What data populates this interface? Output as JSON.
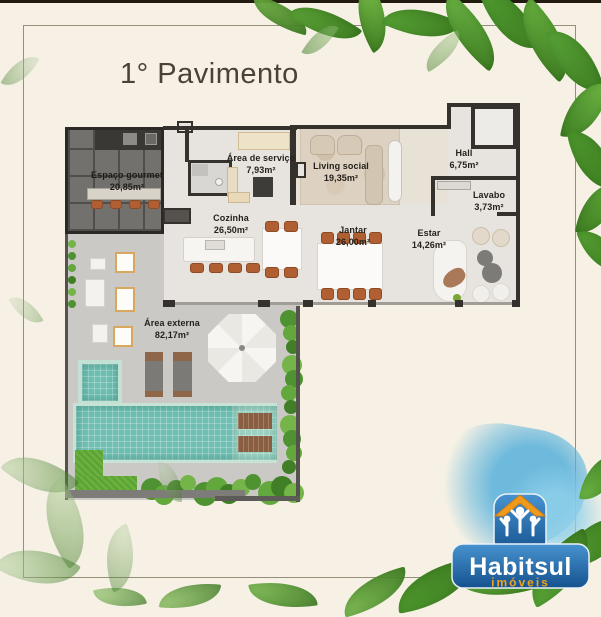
{
  "title": "1° Pavimento",
  "rooms": [
    {
      "name": "Espaço gourmet",
      "area": "20,85m²"
    },
    {
      "name": "Área de serviço",
      "area": "7,93m²"
    },
    {
      "name": "Living social",
      "area": "19,35m²"
    },
    {
      "name": "Hall",
      "area": "6,75m²"
    },
    {
      "name": "Lavabo",
      "area": "3,73m²"
    },
    {
      "name": "Cozinha",
      "area": "26,50m²"
    },
    {
      "name": "Jantar",
      "area": "26,00m²"
    },
    {
      "name": "Estar",
      "area": "14,26m²"
    },
    {
      "name": "Área externa",
      "area": "82,17m²"
    }
  ],
  "logo": {
    "brand": "Habitsul",
    "tagline": "imóveis"
  },
  "icons": {
    "logo_house": "house-with-family-icon"
  },
  "colors": {
    "background": "#f6f1e4",
    "wall": "#35322d",
    "pool_teal": "#6fbfb2",
    "chair_orange": "#b05f33",
    "logo_blue": "#1f6cb0",
    "logo_orange": "#f2a31d",
    "title_text": "#4a4238"
  }
}
